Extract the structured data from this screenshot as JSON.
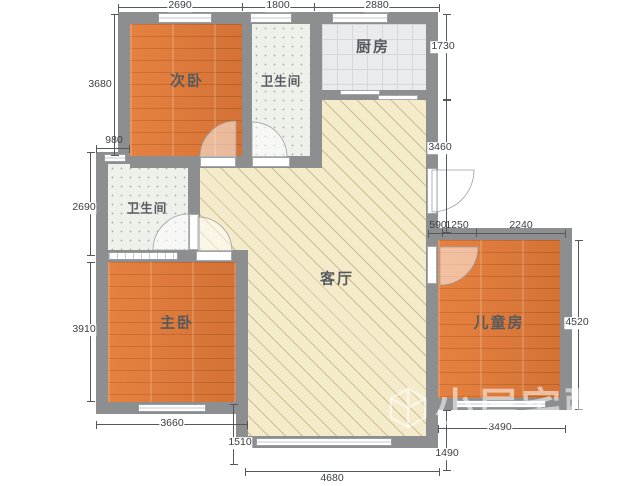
{
  "rooms": {
    "secondary_bedroom": "次卧",
    "bathroom_top": "卫生间",
    "kitchen": "厨房",
    "bathroom_middle": "卫生间",
    "master_bedroom": "主卧",
    "living_room": "客厅",
    "kids_room": "儿童房"
  },
  "dimensions_mm": {
    "top": [
      "2690",
      "1800",
      "2880"
    ],
    "left": [
      "3680",
      "980",
      "2690",
      "3910"
    ],
    "right": [
      "1730",
      "3460",
      "4520"
    ],
    "middle": [
      "590",
      "1250",
      "2240"
    ],
    "bottom": [
      "3660",
      "1510",
      "4680",
      "1490",
      "3490"
    ]
  },
  "watermark": {
    "text": "小层宅配"
  },
  "colors": {
    "wall": "#8c8e90",
    "wood_floor": "#dd7a3e",
    "living_floor": "#f4ebca",
    "tile_floor": "#eef0ea",
    "kitchen_floor": "#e9ebed"
  }
}
